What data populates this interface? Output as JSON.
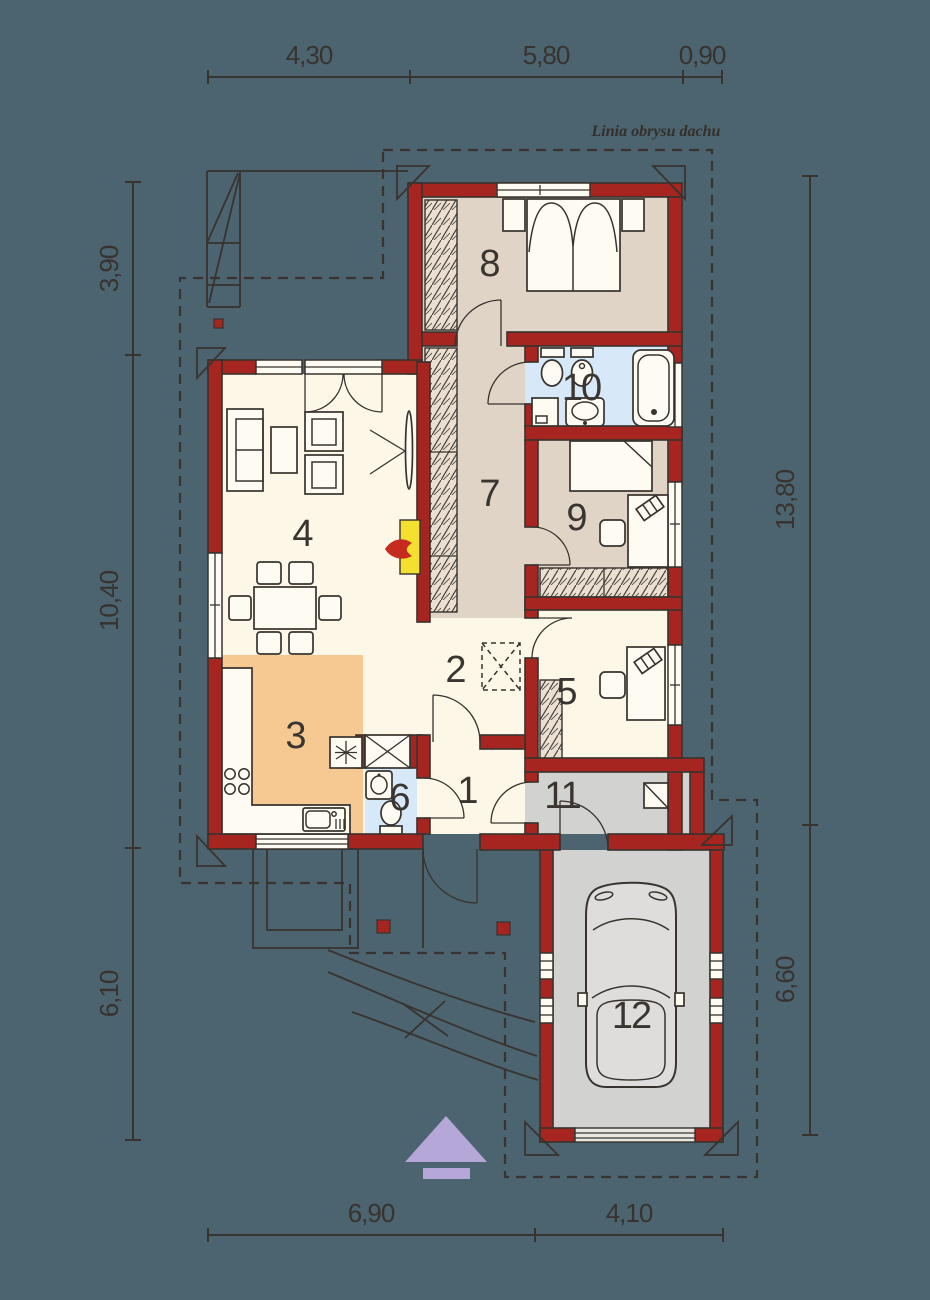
{
  "plan": {
    "roof_outline_label": "Linia obrysu dachu",
    "rooms": [
      {
        "number": "1"
      },
      {
        "number": "2"
      },
      {
        "number": "3"
      },
      {
        "number": "4"
      },
      {
        "number": "5"
      },
      {
        "number": "6"
      },
      {
        "number": "7"
      },
      {
        "number": "8"
      },
      {
        "number": "9"
      },
      {
        "number": "10"
      },
      {
        "number": "11"
      },
      {
        "number": "12"
      }
    ]
  },
  "dimensions": {
    "top": [
      "4,30",
      "5,80",
      "0,90"
    ],
    "left": [
      "3,90",
      "10,40",
      "6,10"
    ],
    "right": [
      "13,80",
      "6,60"
    ],
    "bottom": [
      "6,90",
      "4,10"
    ]
  },
  "colors": {
    "background": "#4c6370",
    "wall_red": "#a62521",
    "line_dark": "#38332e",
    "room_cream": "#fcf7e6",
    "room_beige": "#e0d4c7",
    "room_blue": "#d7e9f8",
    "room_orange": "#f6c992",
    "room_gray": "#d2d2d1",
    "wardrobe_beige": "#eadfd0",
    "counter_white": "#fdfbf2",
    "fireplace_yellow": "#f4e02f",
    "flame_red": "#c62b20",
    "north_arrow_purple": "#b5a7d8"
  }
}
